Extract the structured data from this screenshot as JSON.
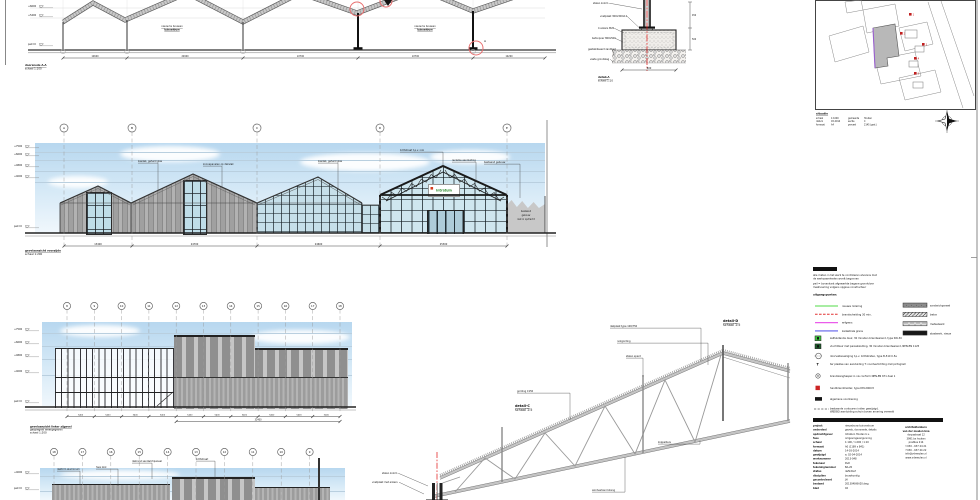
{
  "top_section": {
    "caption": [
      "doorsnede A-A",
      "schaal 1:100"
    ],
    "bay_labels": [
      [
        "nieuw te bouwen",
        "tuincentrum"
      ],
      [
        "nieuw te bouwen",
        "tuincentrum"
      ]
    ],
    "levels": [
      {
        "y": 6,
        "label": "+6600"
      },
      {
        "y": 15,
        "label": "+5400"
      },
      {
        "y": 44,
        "label": "peil=0"
      }
    ],
    "detail_ref": "A",
    "dims": [
      "12600",
      "22900",
      "22700",
      "22700",
      "14200"
    ]
  },
  "foundation_detail": {
    "caption": [
      "detail-A",
      "schaal 1:10"
    ],
    "callouts": [
      "stalen kolom",
      "voetplaat 300x300x12",
      "4 ankers M20",
      "betonpoer 800x500",
      "gestabiliseerd zandbed",
      "vaste grondslag"
    ],
    "dim_bottom": "800",
    "dims_right": [
      "450",
      "500"
    ]
  },
  "site_plan": {
    "title": "situatie",
    "marker_labels": [
      "1",
      "2",
      "3",
      "4",
      "5"
    ],
    "notes_col1": [
      [
        "schaal",
        "1:1000"
      ],
      [
        "datum",
        "03-2014"
      ],
      [
        "formaat",
        "A4"
      ]
    ],
    "notes_col2": [
      [
        "gemeente",
        "Houten"
      ],
      [
        "sectie",
        "C"
      ],
      [
        "perceel",
        "2145 (ged.)"
      ]
    ]
  },
  "front_elevation": {
    "grid_labels": [
      "A",
      "B",
      "C",
      "D",
      "E"
    ],
    "levels": [
      {
        "y": 146,
        "label": "+7500"
      },
      {
        "y": 154,
        "label": "+6600"
      },
      {
        "y": 165,
        "label": "+4800"
      },
      {
        "y": 176,
        "label": "+4000"
      },
      {
        "y": 226,
        "label": "peil=0"
      }
    ],
    "callouts": [
      "kasdek, gehard glas",
      "zonnepanelen op dakvlak",
      "kasdek, gehard glas",
      "lichtstraat t.p.v. nok",
      "reclame aanduiding",
      "bestaand gebouw"
    ],
    "sign_text": "Intratuin",
    "existing_lines": [
      "bestaand",
      "gebouw",
      "niet in opdracht"
    ],
    "dims": [
      "13400",
      "24700",
      "24600",
      "25300"
    ],
    "caption": [
      "gevelaanzicht voorzijde",
      "schaal 1:200"
    ]
  },
  "side_elevation": {
    "grid_labels": [
      "8",
      "9",
      "10",
      "11",
      "12",
      "13",
      "14",
      "15",
      "16",
      "17",
      "18"
    ],
    "levels": [
      {
        "y": 329,
        "label": "+7500"
      },
      {
        "y": 342,
        "label": "+6600"
      },
      {
        "y": 355,
        "label": "+4800"
      },
      {
        "y": 371,
        "label": "+4000"
      },
      {
        "y": 401,
        "label": "peil=0"
      }
    ],
    "dims": [
      "5400",
      "5400",
      "5400",
      "5400",
      "5400",
      "5400",
      "5400",
      "5400",
      "5400",
      "5400"
    ],
    "dim_total": "32400",
    "caption": [
      "gevelaanzicht linker zijgevel",
      "gespiegeld weergegeven",
      "schaal 1:200"
    ]
  },
  "rear_elevation": {
    "grid_labels": [
      "18",
      "17",
      "16",
      "15",
      "14",
      "13",
      "12",
      "11",
      "10",
      "9"
    ],
    "levels": [
      {
        "y": 472,
        "label": "+4000"
      },
      {
        "y": 488,
        "label": "peil=0"
      }
    ],
    "callouts": [
      "daktrim aluminium",
      "hwa zink",
      "dakrand sandwichpaneel",
      "lichtstraat"
    ]
  },
  "isometric": {
    "detail_c": [
      "detail-C",
      "schaal 1:5"
    ],
    "detail_d": [
      "detail-D",
      "schaal 1:5"
    ],
    "callouts": [
      "gording C150",
      "dakplaat type 106/750",
      "nokgording",
      "stalen spant",
      "koppelbuis",
      "windverband stang",
      "stalen kolom",
      "voetplaat met ankers"
    ]
  },
  "legend": {
    "header": "legenda",
    "intro": [
      "alle maten in het werk te controleren alvorens met",
      "de werkzaamheden wordt begonnen",
      "peil = bovenkant afgewerkte begane grondvloer",
      "maatvoering volgens opgave constructeur"
    ],
    "principles_label": "uitgangspunten:",
    "line_items": [
      "nieuwe riolering",
      "brandscheiding 30 min.",
      "erfgrens",
      "kadastrale grens"
    ],
    "box_items": [
      "sandwichpaneel",
      "beton",
      "metselwerk",
      "staalwerk, nieuw"
    ],
    "symbol_t": "T",
    "rows": [
      {
        "label": "zelfsluitende deur, 30 minuten brandwerend, type SW-30"
      },
      {
        "label": "vluchtdeur met panieksluiting, 30 minuten brandwerend, NEN-EN 1125"
      },
      {
        "label": "doorvalbeveiliging t.p.v. lichtstraten, type B-510 0.5a"
      },
      {
        "label": "ter plaatse van aanduiding T: noodverlichting met pictogram"
      },
      {
        "label": "brandslanghaspel in nis conform NEN-EN 671 deel 1"
      },
      {
        "label": "handbrandmelder, type DM-2000rt"
      },
      {
        "label": "algemene voorziening"
      },
      {
        "label": "bestaande contouren indien gewijzigd,",
        "label2": "WBDBO aanduiding schuin boven arcering vermeld"
      }
    ]
  },
  "title_block": {
    "bar": "renvooi: op de aanvraag van toepassing zijnde stukken",
    "fields": [
      [
        "project",
        "nieuwbouw tuincentrum"
      ],
      [
        "onderdeel",
        "gevels, doorsnede, details"
      ],
      [
        "opdrachtgever",
        "Intratuin Houten b.v."
      ],
      [
        "fase",
        "omgevingsvergunning"
      ],
      [
        "schaal",
        "1:100 / 1:200 / 1:10"
      ],
      [
        "formaat",
        "A0 (1189 x 841)"
      ],
      [
        "datum",
        "14-03-2014"
      ],
      [
        "gewijzigd",
        "a: 02-04-2014"
      ],
      [
        "werknummer",
        "2013-048"
      ],
      [
        "tekenaar",
        "RvD"
      ],
      [
        "tekeningnummer",
        "BA-20"
      ],
      [
        "status",
        "definitief"
      ],
      [
        "discipline",
        "bouwkundig"
      ],
      [
        "gecontroleerd",
        "JH"
      ],
      [
        "bestand",
        "2013048-BA20.dwg"
      ],
      [
        "blad",
        "02"
      ]
    ],
    "company": [
      "architektenburo",
      "van der meulen bna",
      "dorpsstraat 12",
      "3991 bx houten",
      "postbus 214",
      "t 030 - 637 44 21",
      "f 030 - 637 44 22",
      "info@vdmeulen.nl",
      "www.vdmeulen.nl"
    ]
  }
}
